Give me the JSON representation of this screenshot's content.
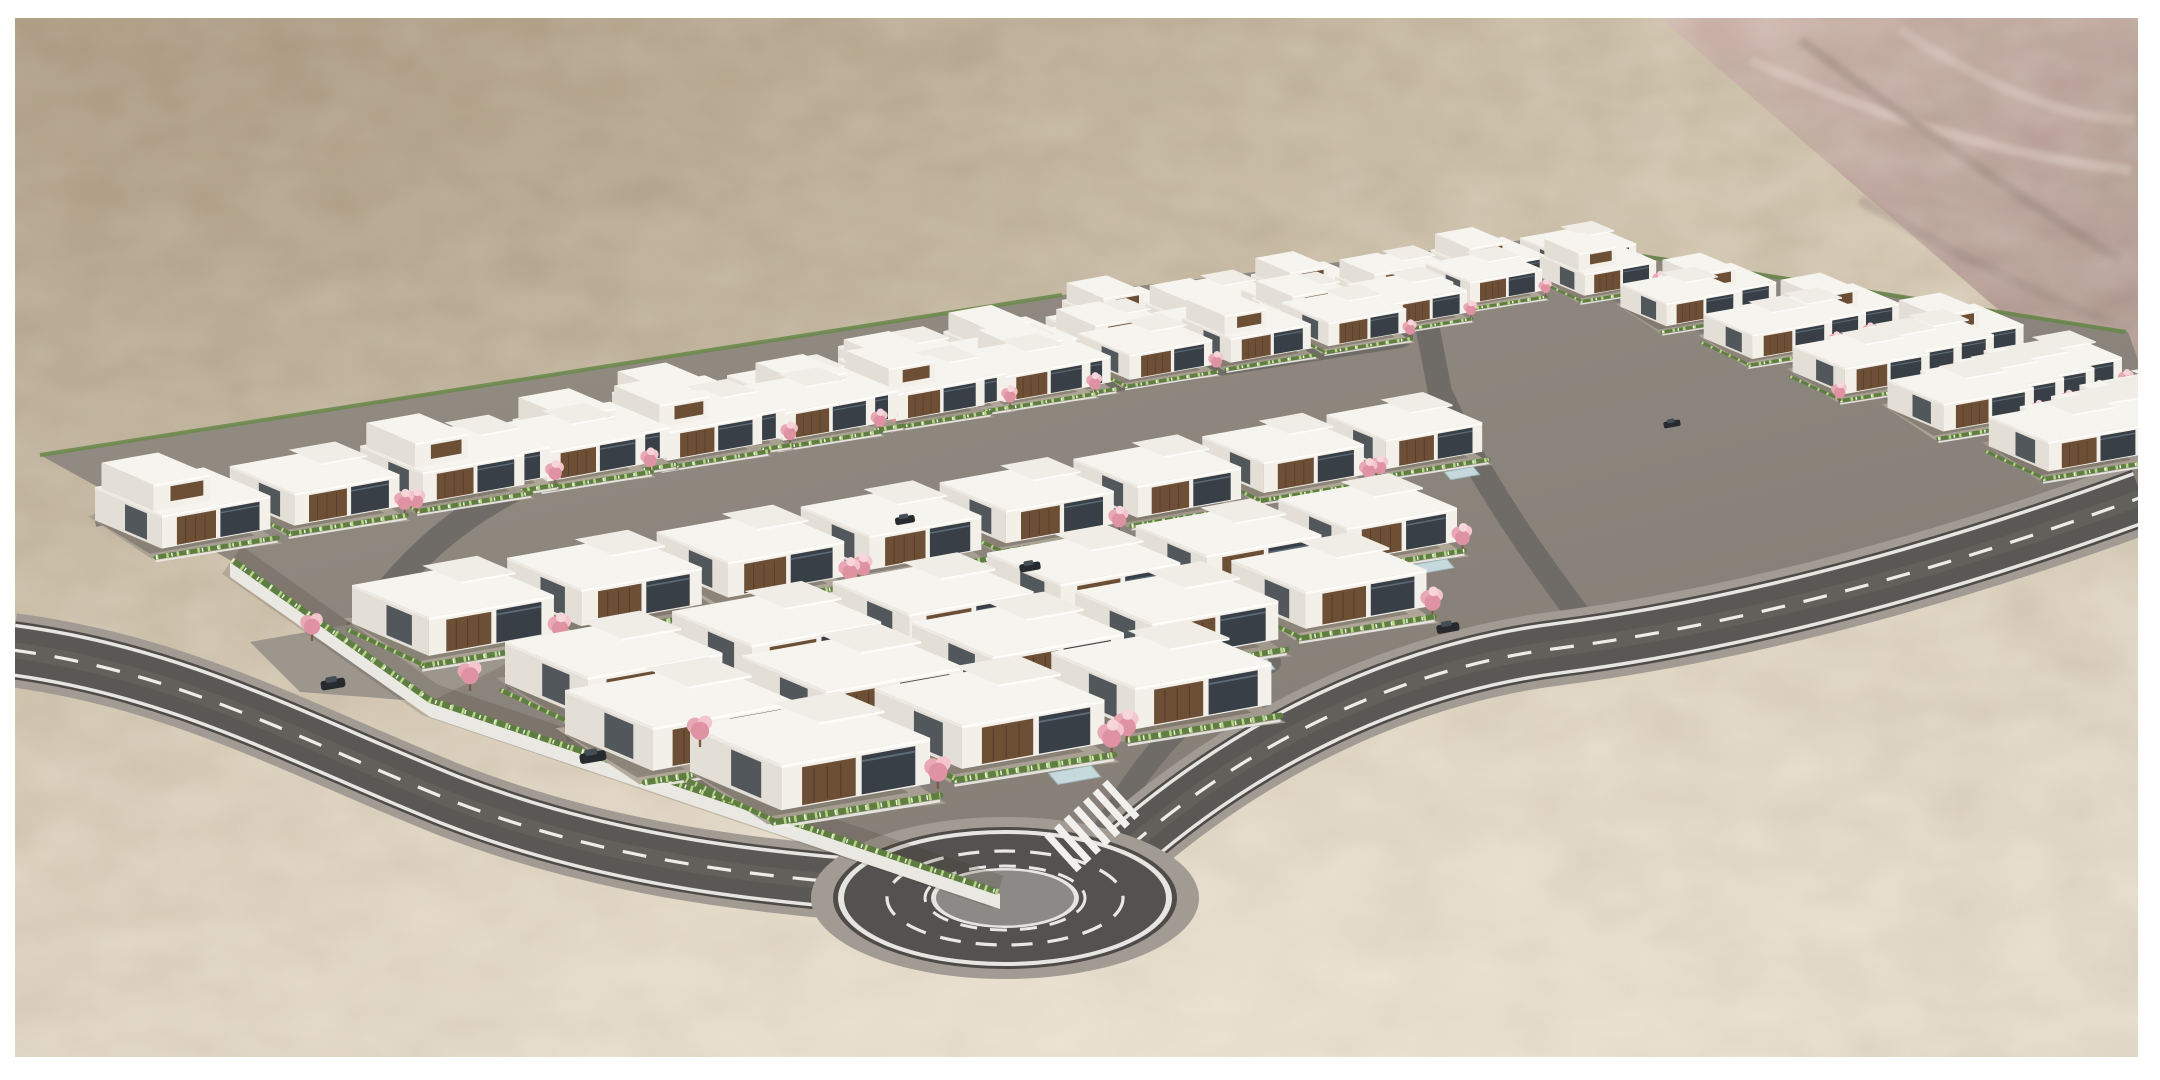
{
  "meta": {
    "title": "Aerial 3D architectural rendering: desert residential development with rows of white modern villas, pink blossom trees, green hedges, perimeter roads and a roundabout",
    "visible_text": "none"
  },
  "scene": {
    "canvas": {
      "w": 2160,
      "h": 1080
    },
    "frame": {
      "left": 15,
      "top": 18,
      "right": 22,
      "bottom": 23,
      "color": "#ffffff"
    },
    "desert": {
      "gradient": [
        "#b7a68d",
        "#ccbfa8",
        "#d8ccb8",
        "#e2d8c7"
      ],
      "noise_dark": "#6b5d4a",
      "noise_light": "#f2e9d8",
      "veil_topleft": "#8e7c64",
      "glow_bottom": "#f6eddd",
      "ridge": {
        "points": "1660,18 2138,18 2138,430",
        "light": "#cbb0a9",
        "dark": "#a98f89",
        "streaks": [
          {
            "d": "M 1750,60 Q 1950,150 2130,170",
            "c": "#e8d8d1"
          },
          {
            "d": "M 1800,40 Q 1990,180 2120,260",
            "c": "#8f7a72"
          },
          {
            "d": "M 1900,30 Q 2040,120 2135,120",
            "c": "#dcc9c2"
          },
          {
            "d": "M 1860,200 Q 2000,280 2130,330",
            "c": "#97837b"
          }
        ]
      }
    },
    "estate": {
      "pad_points": "40,455 1062,295 1540,238 2128,332 2138,360 2138,497 1560,645 1128,840 1005,893 430,700 230,560",
      "pad_fill_a": "#958e85",
      "pad_fill_b": "#837c74",
      "nw_hedge": {
        "d": "M 40,455 L 1062,295",
        "color": "#6b8a4c",
        "w": 4
      },
      "ne_hedge": {
        "d": "M 1540,240 L 2126,332",
        "color": "#67864a",
        "w": 4
      },
      "wall": {
        "points": "230,562 430,702 1000,894 1000,909 430,717 230,577",
        "fill": "#eae8e2",
        "hedge_d": "M 232,560 L 430,700 L 998,892",
        "hedge_color": "#5d7d42",
        "hedge_w": 6,
        "speckle": "#b9d488",
        "flower": "#eff3e3"
      },
      "entry_apron": {
        "points": "250,642 420,612 530,652 430,702 300,692",
        "fill": "#9d968d"
      },
      "rows": [
        {
          "x": 1062,
          "y": 300,
          "slope": -0.136,
          "len": 480
        },
        {
          "x": 838,
          "y": 346,
          "slope": -0.141,
          "len": 610
        },
        {
          "x": 612,
          "y": 392,
          "slope": -0.147,
          "len": 820
        },
        {
          "x": 388,
          "y": 438,
          "slope": -0.152,
          "len": 950
        },
        {
          "x": 95,
          "y": 487,
          "slope": -0.156,
          "len": 950
        },
        {
          "x": 352,
          "y": 585,
          "slope": -0.175,
          "len": 1000,
          "front": true
        },
        {
          "x": 505,
          "y": 642,
          "slope": -0.185,
          "len": 800,
          "front": true
        },
        {
          "x": 565,
          "y": 690,
          "slope": -0.195,
          "len": 700,
          "front": true
        },
        {
          "x": 690,
          "y": 726,
          "slope": -0.205,
          "len": 500,
          "front": true
        }
      ],
      "cols": [
        {
          "x": 1540,
          "y": 255,
          "slope": 0.36,
          "len": 490
        },
        {
          "x": 1658,
          "y": 276,
          "slope": 0.36,
          "len": 440
        },
        {
          "x": 1776,
          "y": 297,
          "slope": 0.36,
          "len": 330
        },
        {
          "x": 1894,
          "y": 318,
          "slope": 0.36,
          "len": 220
        }
      ],
      "street": {
        "offset": 46,
        "color": "#79746e",
        "w": 18,
        "col_offset": 58
      },
      "house": {
        "w": 150,
        "d": 115,
        "wall_h": 46,
        "upper_h": 32,
        "roof": "#f6f4ee",
        "roof_fascia": "#fdfcf9",
        "roof_side": "#edeae3",
        "roof_step": "#f0ede7",
        "wall_front": "#f3f0ea",
        "wall_side": "#e3dfd7",
        "wood": "#6d4f36",
        "wood_dark": "#553c28",
        "glass": "#383f46",
        "glass_hi": "#5d6b77",
        "shadow": "rgba(55,48,40,0.28)",
        "grounds": [
          "#a89f93",
          "#aba295",
          "#a29a8d",
          "#b1a89a"
        ],
        "hedge": "#5e7e42",
        "hedge_speckle": "#b9d488",
        "hedge_flower": "#f0f4e6",
        "terrace_wall": "#ecebe7",
        "pool": "#c6d9dc",
        "pool_edge": "#9fb7ba",
        "tree_trunk": "#7b5a43",
        "tree": [
          "#e9a9b4",
          "#f3c6cd",
          "#df93a2",
          "#f6d6da"
        ]
      },
      "mods": {
        "two_story": 2,
        "tree_skip": 4,
        "pool": 2,
        "side_hedge": 3
      }
    },
    "roads": {
      "style": {
        "sidewalk": "#a19b93",
        "sidewalk_w": 74,
        "casing": "#4e4b48",
        "casing_w": 58,
        "edge": "#e7e5e1",
        "edge_w": 53,
        "asphalt": "#5a5855",
        "asphalt_w": 46,
        "wear": "#6a6762",
        "wear_w": 16,
        "dash": "#ecece8",
        "dash_w": 3.2,
        "dash_array": "24 19"
      },
      "main": [
        {
          "d": "M 12,650 C 180,672 300,740 450,800 C 620,866 780,878 910,888"
        },
        {
          "d": "M 1128,848 C 1250,742 1400,668 1560,648 C 1760,622 1965,562 2142,497"
        }
      ],
      "internal": [
        {
          "d": "M 340,658 C 400,560 470,500 575,462 L 1400,335",
          "w": 26
        },
        {
          "d": "M 1595,636 C 1520,540 1470,460 1440,392 L 1428,330",
          "w": 24
        },
        {
          "d": "M 1105,828 C 1140,766 1190,702 1270,662",
          "w": 22
        }
      ],
      "internal_color": "#6f6b66",
      "roundabout": {
        "cx": 1005,
        "cy": 898,
        "apron": [
          194,
          81
        ],
        "casing": [
          172,
          71
        ],
        "edge": [
          167,
          68
        ],
        "ring": [
          161,
          64
        ],
        "dash_outer": [
          118,
          47
        ],
        "dash_inner": [
          80,
          32
        ],
        "inner_edge": [
          74,
          30
        ],
        "island": [
          69,
          27.5
        ],
        "island_fill": "#8b8a86",
        "ring_fill": "#535250",
        "dash": "#e9e8e4"
      },
      "crosswalk": {
        "cx": 1092,
        "cy": 826,
        "dir": [
          0.74,
          -0.67
        ],
        "n": 7,
        "gap": 13,
        "half_len": 24,
        "half_w": 3.6,
        "color": "#f1f0ec"
      }
    },
    "trees_standalone": [
      [
        312,
        640
      ],
      [
        470,
        690
      ],
      [
        700,
        746
      ],
      [
        938,
        788
      ]
    ],
    "cars": [
      [
        333,
        684
      ],
      [
        593,
        757
      ],
      [
        1030,
        567
      ],
      [
        1448,
        628
      ],
      [
        905,
        520
      ],
      [
        1672,
        424
      ]
    ],
    "car": {
      "body": "#272b2f",
      "top": "#454d55"
    }
  }
}
